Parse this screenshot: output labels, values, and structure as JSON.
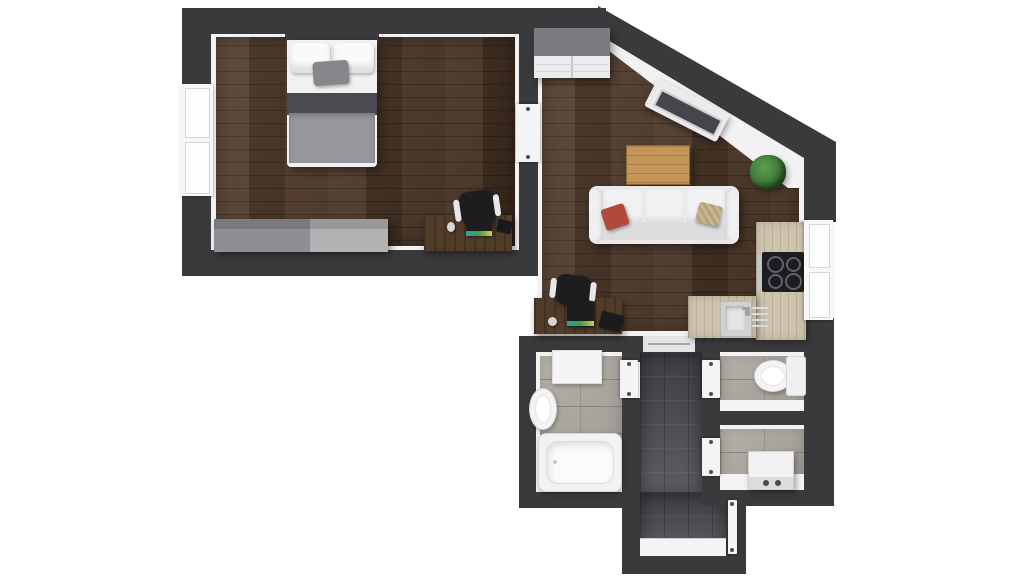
{
  "app": {
    "type": "3d-floor-plan",
    "view": "top-down-render",
    "background": "#ffffff"
  },
  "colors": {
    "wall": "#3a3a3d",
    "trim": "#f2f2f3",
    "wood": "#4b3423",
    "desk": "#503c29",
    "counter": "#cdc3ae",
    "tileLight": "#aba69e",
    "tileDark": "#55555b",
    "fixture": "#f4f4f5",
    "sofa": "#e9e9eb",
    "grayFurniture": "#9b9b9f",
    "wardrobeTop": "#7b7b7f",
    "oak": "#c49458",
    "plant": "#3e7d38",
    "appliance": "#1d1d20",
    "chair": "#1d1d20",
    "accentRed": "#b24a3b",
    "accentBeige": "#c9b58f",
    "throwGray": "#98989c",
    "blanketDark": "#4a4a50",
    "cushionGray": "#86868b",
    "screenTeal": "#1fa7a0"
  },
  "rooms": [
    {
      "id": "bedroom",
      "floor": "dark-wood",
      "furniture": [
        "double-bed",
        "white-pillows",
        "gray-cushion",
        "gray-throw",
        "dresser",
        "desk",
        "office-chair",
        "laptop",
        "mouse",
        "window"
      ]
    },
    {
      "id": "living-room",
      "floor": "dark-wood",
      "furniture": [
        "wardrobe",
        "tv-panel-on-diagonal-wall",
        "coffee-table",
        "plant",
        "three-seat-sofa",
        "red-pillow",
        "beige-pillow",
        "desk",
        "office-chair",
        "laptop",
        "window"
      ]
    },
    {
      "id": "kitchen",
      "floor": "dark-wood",
      "furniture": [
        "l-shaped-counter",
        "cooktop-4-burners",
        "oven-handle",
        "sink",
        "faucet",
        "drainer"
      ]
    },
    {
      "id": "bathroom",
      "floor": "light-gray-tile",
      "furniture": [
        "bathtub",
        "washbasin",
        "shower-tray",
        "door"
      ]
    },
    {
      "id": "wc",
      "floor": "light-gray-tile",
      "furniture": [
        "wall-hung-toilet",
        "door"
      ]
    },
    {
      "id": "utility",
      "floor": "light-gray-tile",
      "furniture": [
        "washing-machine",
        "door"
      ]
    },
    {
      "id": "hallway",
      "floor": "dark-gray-tile",
      "furniture": [
        "threshold-rail",
        "bathroom-door",
        "wc-door",
        "utility-door",
        "entry-door"
      ]
    }
  ]
}
